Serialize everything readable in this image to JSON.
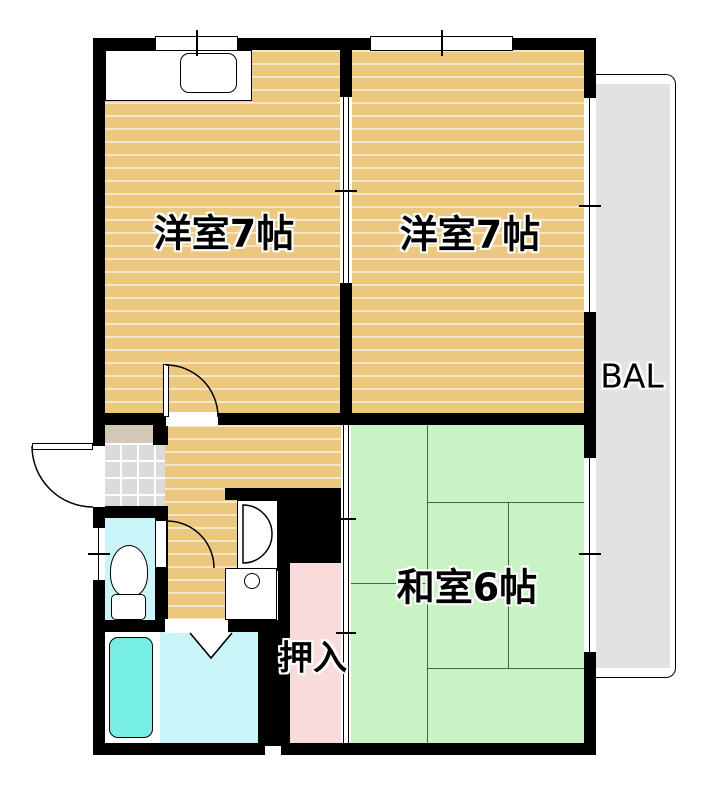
{
  "plan": {
    "type": "apartment-floor-plan",
    "rooms": {
      "bedroom_left": {
        "label": "洋室7帖"
      },
      "bedroom_right": {
        "label": "洋室7帖"
      },
      "japanese_room": {
        "label": "和室6帖"
      },
      "closet": {
        "label": "押入"
      },
      "balcony": {
        "label": "BAL"
      }
    },
    "colors": {
      "wood_floor": "#EBC87E",
      "tatami": "#C9F3C4",
      "closet_pink": "#F9DBDB",
      "wet_area_cyan": "#C9F5F8",
      "bathtub": "#76EEE6",
      "entrance_tile": "#DBDBDB",
      "entrance_step": "#D3C7B5",
      "balcony_gray": "#E2E2E2",
      "wall": "#000000"
    }
  }
}
